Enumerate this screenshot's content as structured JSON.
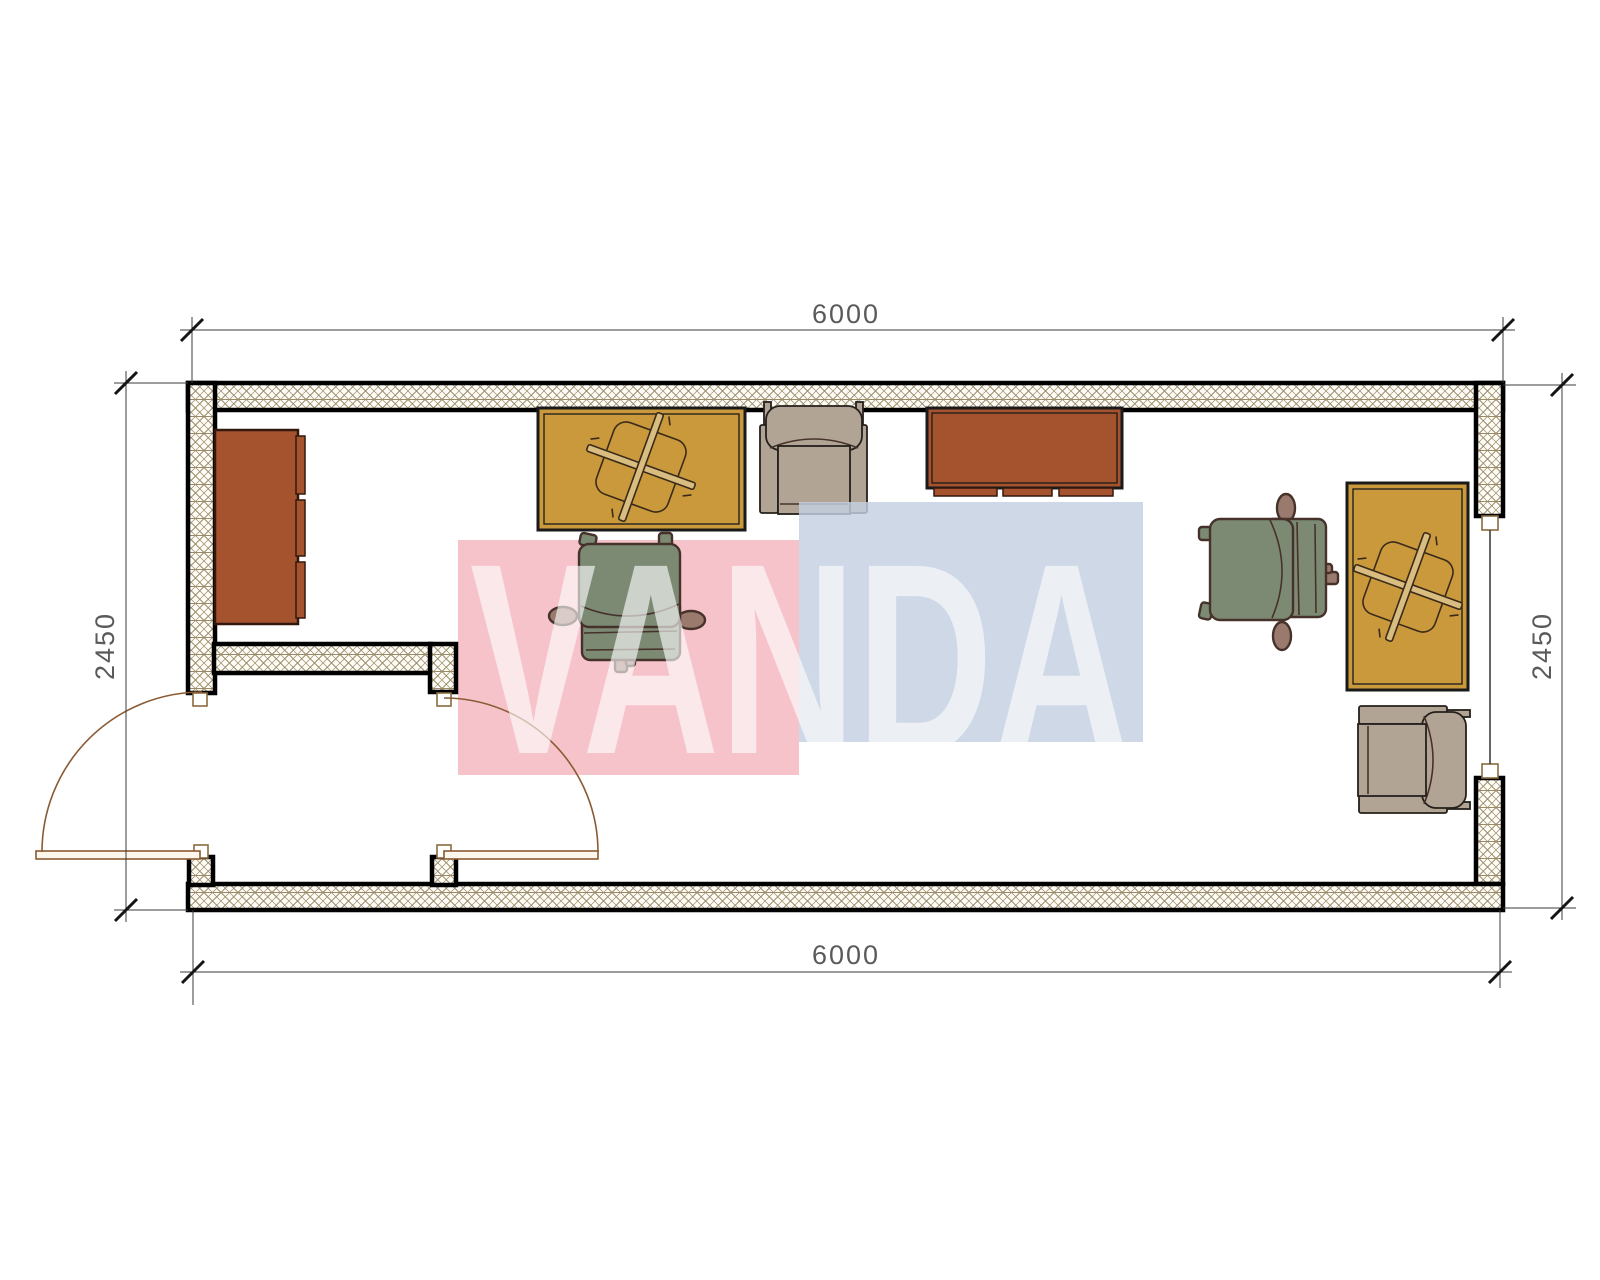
{
  "dimensions": {
    "top": "6000",
    "bottom": "6000",
    "left": "2450",
    "right": "2450"
  },
  "watermark": {
    "text": "VANDA",
    "pink_color": "#F6C3CB",
    "blue_color": "#C3D0E2",
    "letter_color": "#ffffff"
  },
  "colors": {
    "hatch_line": "#9a8a68",
    "wall_edge": "#000000",
    "brown_furniture": "#A5532E",
    "yellow_desk": "#C9993B",
    "yellow_symbol": "#D9BD80",
    "beige_chair": "#B2A494",
    "sage_chair": "#7C8A74",
    "hand": "#9B7A6E",
    "door_swing": "#8a5a33",
    "dim_text": "#5a5a5a"
  },
  "plan": {
    "type": "container-office-floor-plan",
    "room_width_mm": "6000",
    "room_depth_mm": "2450",
    "furniture": [
      {
        "id": "cabinet-left",
        "kind": "sideboard-cabinet",
        "color": "#A5532E"
      },
      {
        "id": "desk-left",
        "kind": "desk-with-chair-base-symbol",
        "color": "#C9993B"
      },
      {
        "id": "armchair-top",
        "kind": "armchair",
        "color": "#B2A494"
      },
      {
        "id": "desk-center",
        "kind": "credenza-desk",
        "color": "#A5532E"
      },
      {
        "id": "office-chair-left",
        "kind": "swivel-chair",
        "color": "#7C8A74"
      },
      {
        "id": "office-chair-right",
        "kind": "swivel-chair",
        "color": "#7C8A74"
      },
      {
        "id": "desk-right",
        "kind": "desk-with-chair-base-symbol",
        "color": "#C9993B"
      },
      {
        "id": "armchair-bottom-right",
        "kind": "armchair",
        "color": "#B2A494"
      }
    ],
    "openings": [
      {
        "id": "entry-door",
        "kind": "swing-door-exterior"
      },
      {
        "id": "vestibule-door",
        "kind": "swing-door-interior"
      },
      {
        "id": "window-right",
        "kind": "window"
      }
    ]
  }
}
